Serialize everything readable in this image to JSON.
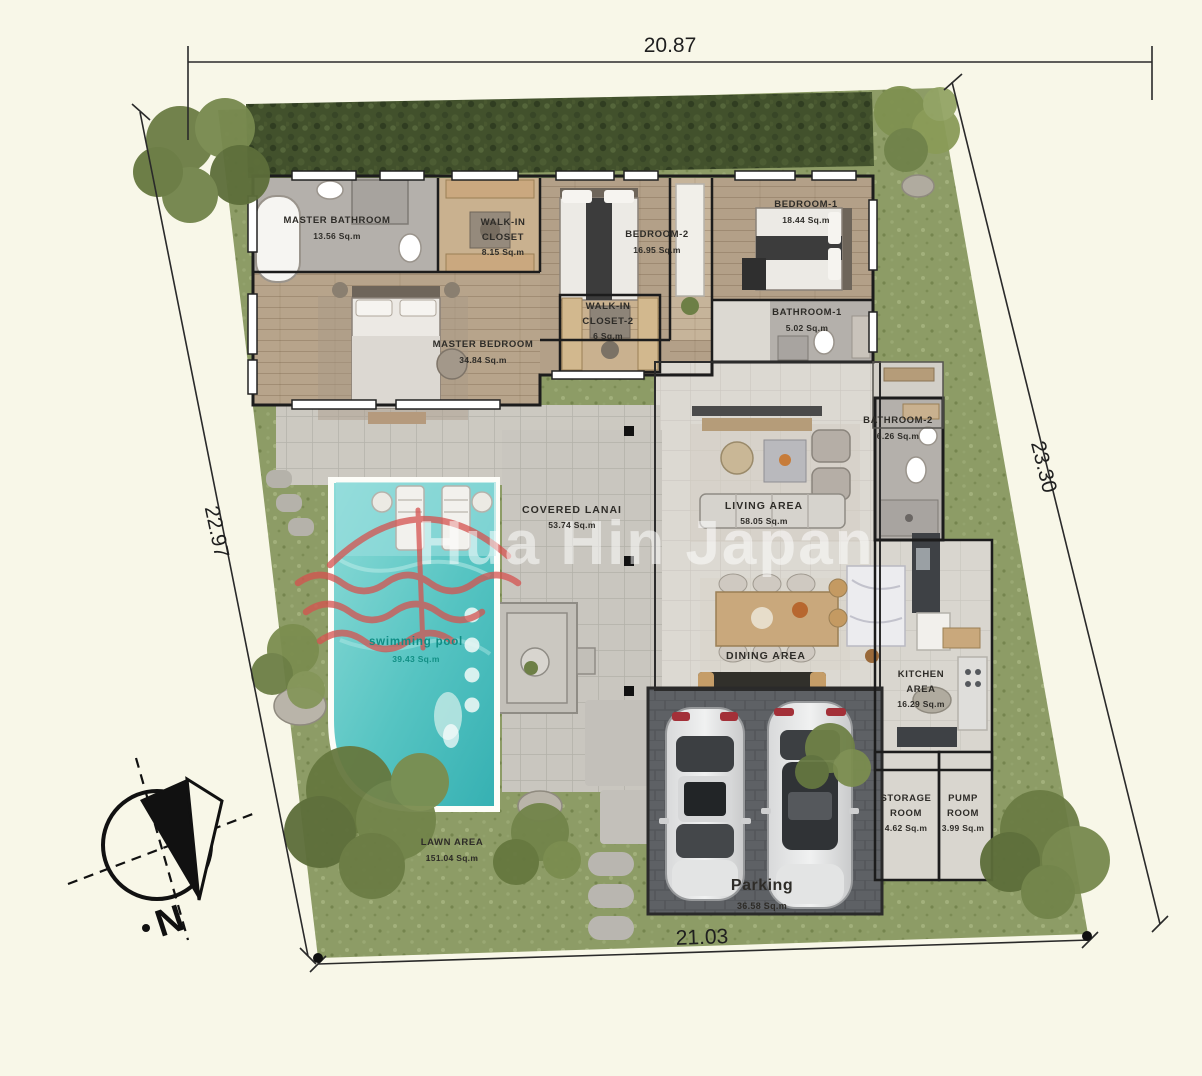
{
  "plan": {
    "watermark": "Hua Hin Japan",
    "compass_label": "N",
    "dimensions": {
      "top": "20.87",
      "bottom": "21.03",
      "left": "22.97",
      "right": "23.30"
    }
  },
  "rooms": [
    {
      "name": "MASTER BATHROOM",
      "area": "13.56 Sq.m"
    },
    {
      "name": "WALK-IN CLOSET",
      "area": "8.15 Sq.m"
    },
    {
      "name": "BEDROOM-2",
      "area": "16.95 Sq.m"
    },
    {
      "name": "BEDROOM-1",
      "area": "18.44 Sq.m"
    },
    {
      "name": "WALK-IN CLOSET-2",
      "area": "6 Sq.m"
    },
    {
      "name": "BATHROOM-1",
      "area": "5.02 Sq.m"
    },
    {
      "name": "MASTER BEDROOM",
      "area": "34.84 Sq.m"
    },
    {
      "name": "BATHROOM-2",
      "area": "6.26 Sq.m"
    },
    {
      "name": "COVERED LANAI",
      "area": "53.74 Sq.m"
    },
    {
      "name": "LIVING AREA",
      "area": "58.05 Sq.m"
    },
    {
      "name": "swimming pool",
      "area": "39.43 Sq.m"
    },
    {
      "name": "DINING AREA",
      "area": ""
    },
    {
      "name": "KITCHEN AREA",
      "area": "16.29 Sq.m"
    },
    {
      "name": "STORAGE ROOM",
      "area": "4.62 Sq.m"
    },
    {
      "name": "PUMP ROOM",
      "area": "3.99 Sq.m"
    },
    {
      "name": "LAWN AREA",
      "area": "151.04 Sq.m"
    },
    {
      "name": "Parking",
      "area": "36.58 Sq.m"
    }
  ],
  "colors": {
    "background": "#f8f7e8",
    "grass": "#8d9c66",
    "pool": "#56c4c2",
    "parking_pavers": "#5e6165",
    "watermark_red": "#d5524f",
    "label_text": "#2e2c28",
    "pool_label_text": "#0f8d84"
  }
}
